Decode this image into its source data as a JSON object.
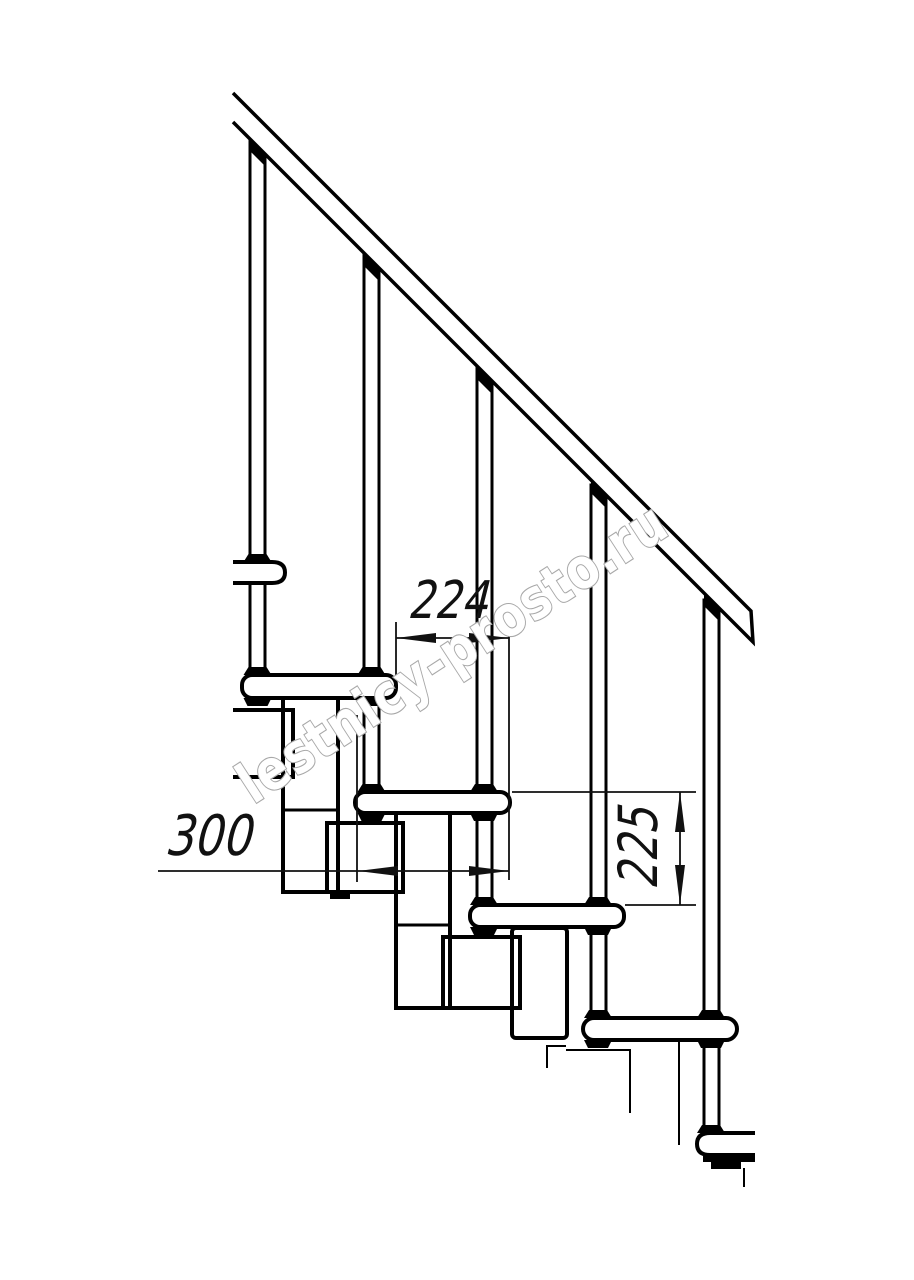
{
  "page": {
    "background": "#ffffff"
  },
  "drawing": {
    "type": "staircase-side-view-technical-drawing",
    "line_color": "#000000",
    "dimension_color": "#111111",
    "dimensions": [
      {
        "id": "step-run",
        "value": "224",
        "orientation": "horizontal"
      },
      {
        "id": "tread-depth",
        "value": "300",
        "orientation": "horizontal"
      },
      {
        "id": "riser-height",
        "value": "225",
        "orientation": "vertical"
      }
    ],
    "watermark": {
      "text": "lestnicy-prosto.ru",
      "fill": "#ffffff",
      "outline": "#a8a8a8"
    },
    "components": {
      "balusters": 5,
      "treads": 6,
      "handrail": 1
    }
  }
}
